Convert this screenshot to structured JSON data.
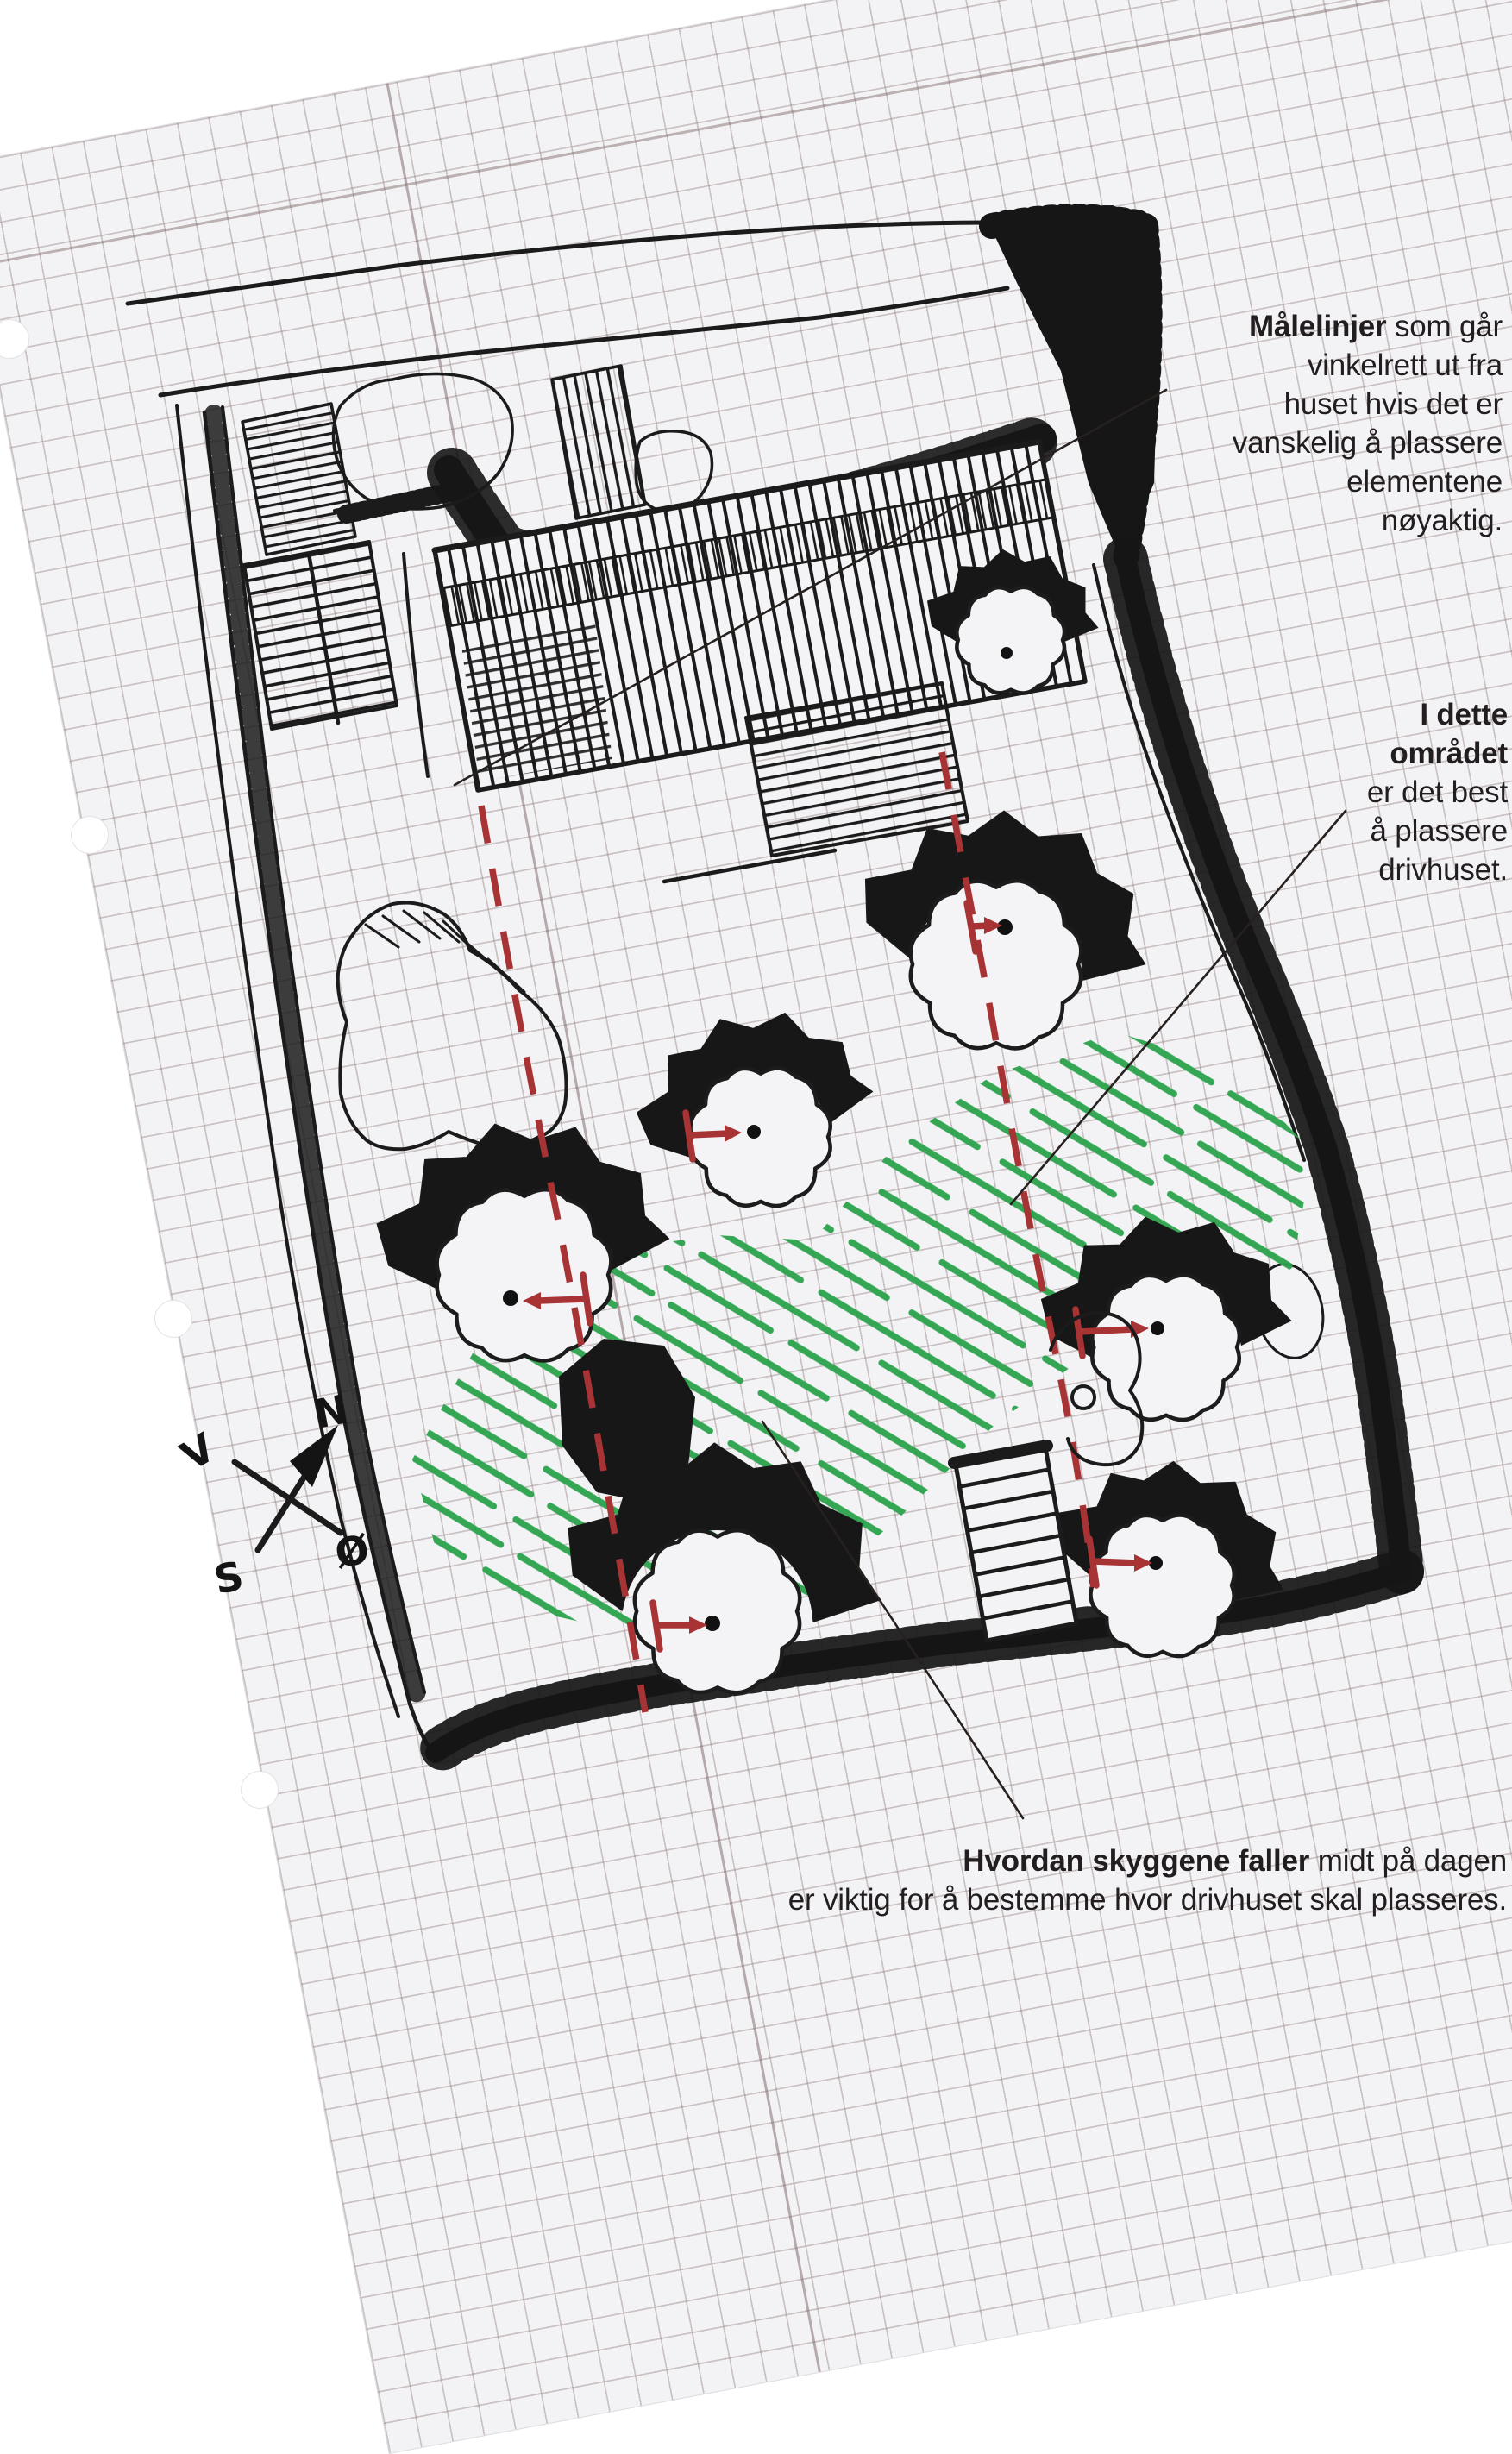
{
  "annotations": {
    "measure": {
      "bold": "Målelinjer",
      "rest": " som går",
      "lines": [
        "vinkelrett ut fra",
        "huset hvis det er",
        "vanskelig å plassere",
        "elementene",
        "nøyaktig."
      ]
    },
    "area": {
      "bold_lines": [
        "I dette",
        "området"
      ],
      "lines": [
        "er det best",
        "å plassere",
        "drivhuset."
      ]
    },
    "shadow": {
      "bold": "Hvordan skyggene faller",
      "rest": " midt på dagen",
      "line2": "er viktig for å bestemme hvor drivhuset skal plasseres."
    }
  },
  "compass": {
    "n": "N",
    "s": "S",
    "e": "Ø",
    "w": "V"
  },
  "colors": {
    "ink": "#1b1b1b",
    "red": "#a83335",
    "green": "#2ba24c",
    "paper": "#f3f3f6",
    "grid": "rgba(146,124,124,0.42)"
  }
}
